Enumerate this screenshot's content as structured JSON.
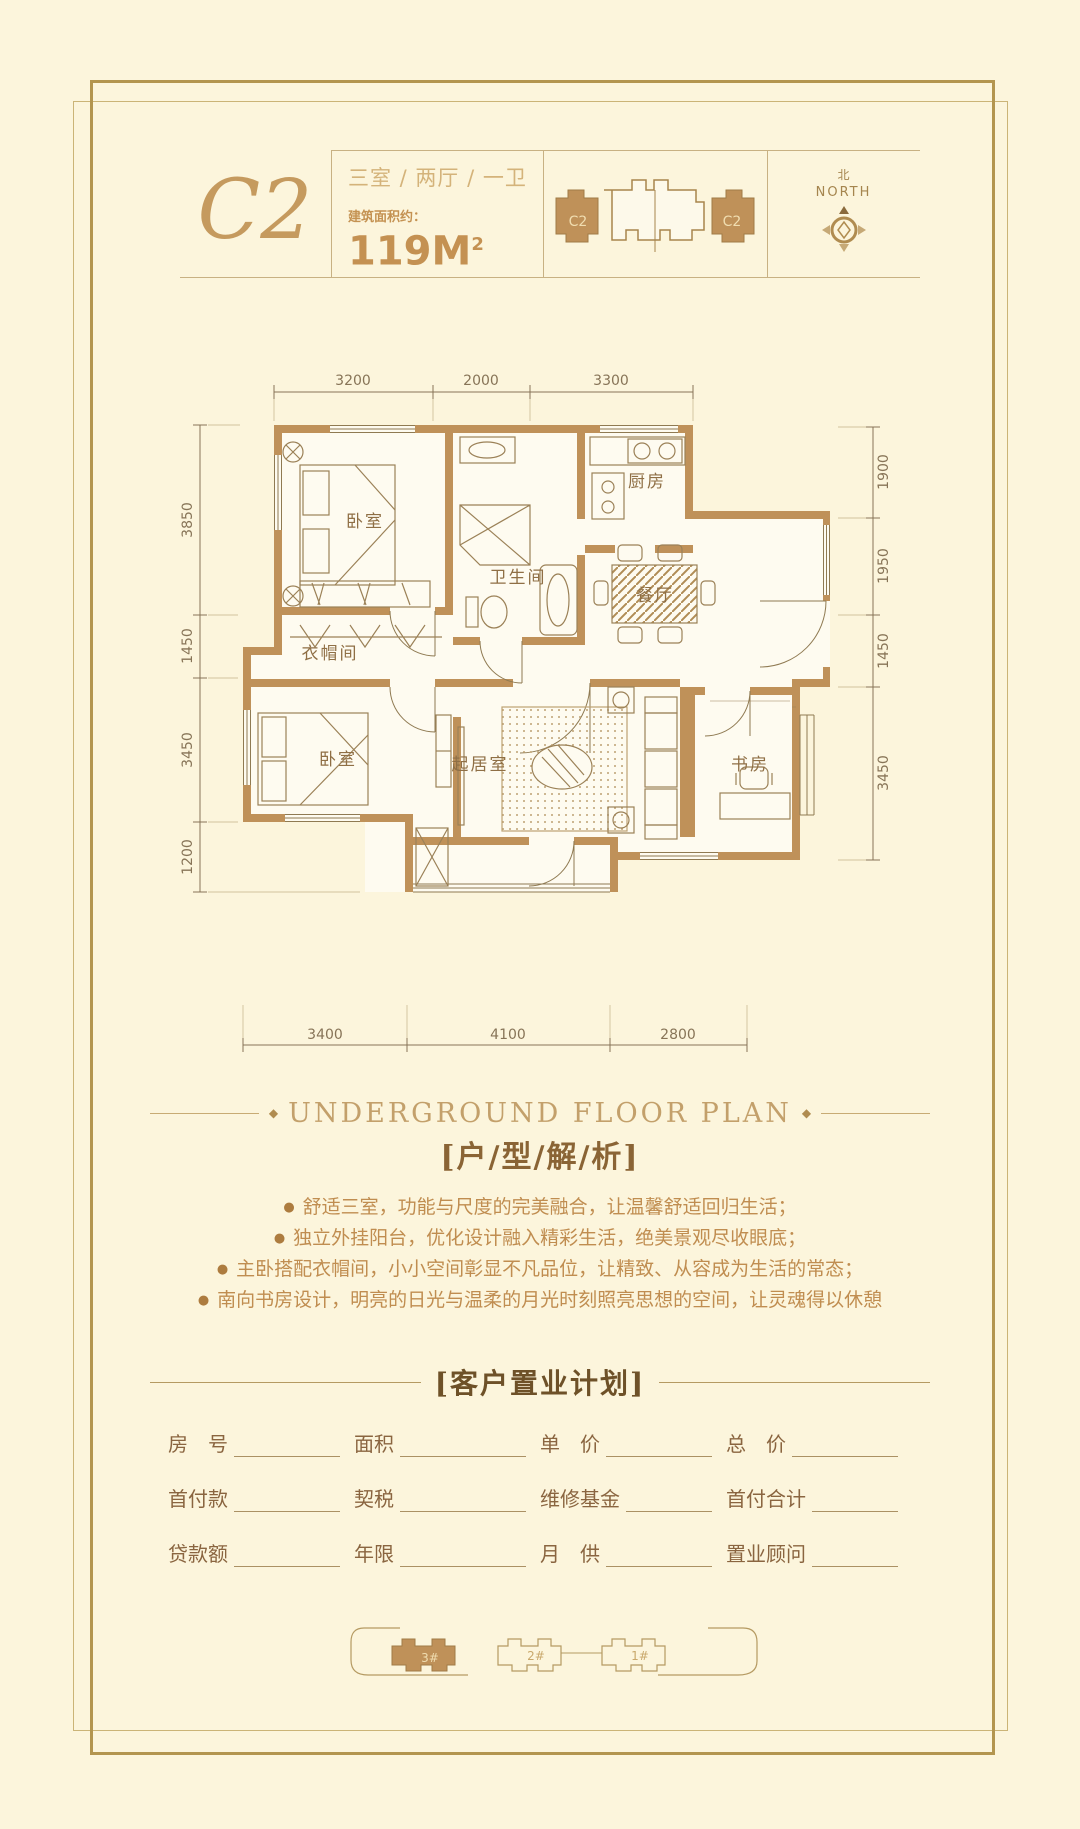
{
  "page": {
    "bg": "#fcf5dc",
    "accent": "#bf9159"
  },
  "header": {
    "unit_code": "C2",
    "layout": "三室 / 两厅 / 一卫",
    "area_label": "建筑面积约：",
    "area_value": "119M",
    "area_sup": "2",
    "keyplan": {
      "left_label": "C2",
      "right_label": "C2"
    },
    "compass": {
      "cn": "北",
      "en": "NORTH"
    }
  },
  "plan": {
    "rooms": [
      "卧室",
      "卫生间",
      "厨房",
      "餐厅",
      "衣帽间",
      "卧室",
      "起居室",
      "书房"
    ],
    "dims_top": [
      "3200",
      "2000",
      "3300"
    ],
    "dims_bottom": [
      "3400",
      "4100",
      "2800"
    ],
    "dims_left": [
      "3850",
      "1450",
      "3450",
      "1200"
    ],
    "dims_right": [
      "1900",
      "1950",
      "1450",
      "3450"
    ]
  },
  "analysis": {
    "ornament": "◆",
    "bullet_char": "●",
    "title_en": "UNDERGROUND FLOOR PLAN",
    "title_cn": "[户/型/解/析]",
    "bullets": [
      "舒适三室，功能与尺度的完美融合，让温馨舒适回归生活；",
      "独立外挂阳台，优化设计融入精彩生活，绝美景观尽收眼底；",
      "主卧搭配衣帽间，小小空间彰显不凡品位，让精致、从容成为生活的常态；",
      "南向书房设计，明亮的日光与温柔的月光时刻照亮思想的空间，让灵魂得以休憩"
    ]
  },
  "purchase_plan": {
    "title": "[客户置业计划]",
    "rows": [
      [
        "房　号",
        "面积",
        "单　价",
        "总　价"
      ],
      [
        "首付款",
        "契税",
        "维修基金",
        "首付合计"
      ],
      [
        "贷款额",
        "年限",
        "月　供",
        "置业顾问"
      ]
    ]
  },
  "siteplan": {
    "buildings": [
      "3#",
      "2#",
      "1#"
    ]
  }
}
